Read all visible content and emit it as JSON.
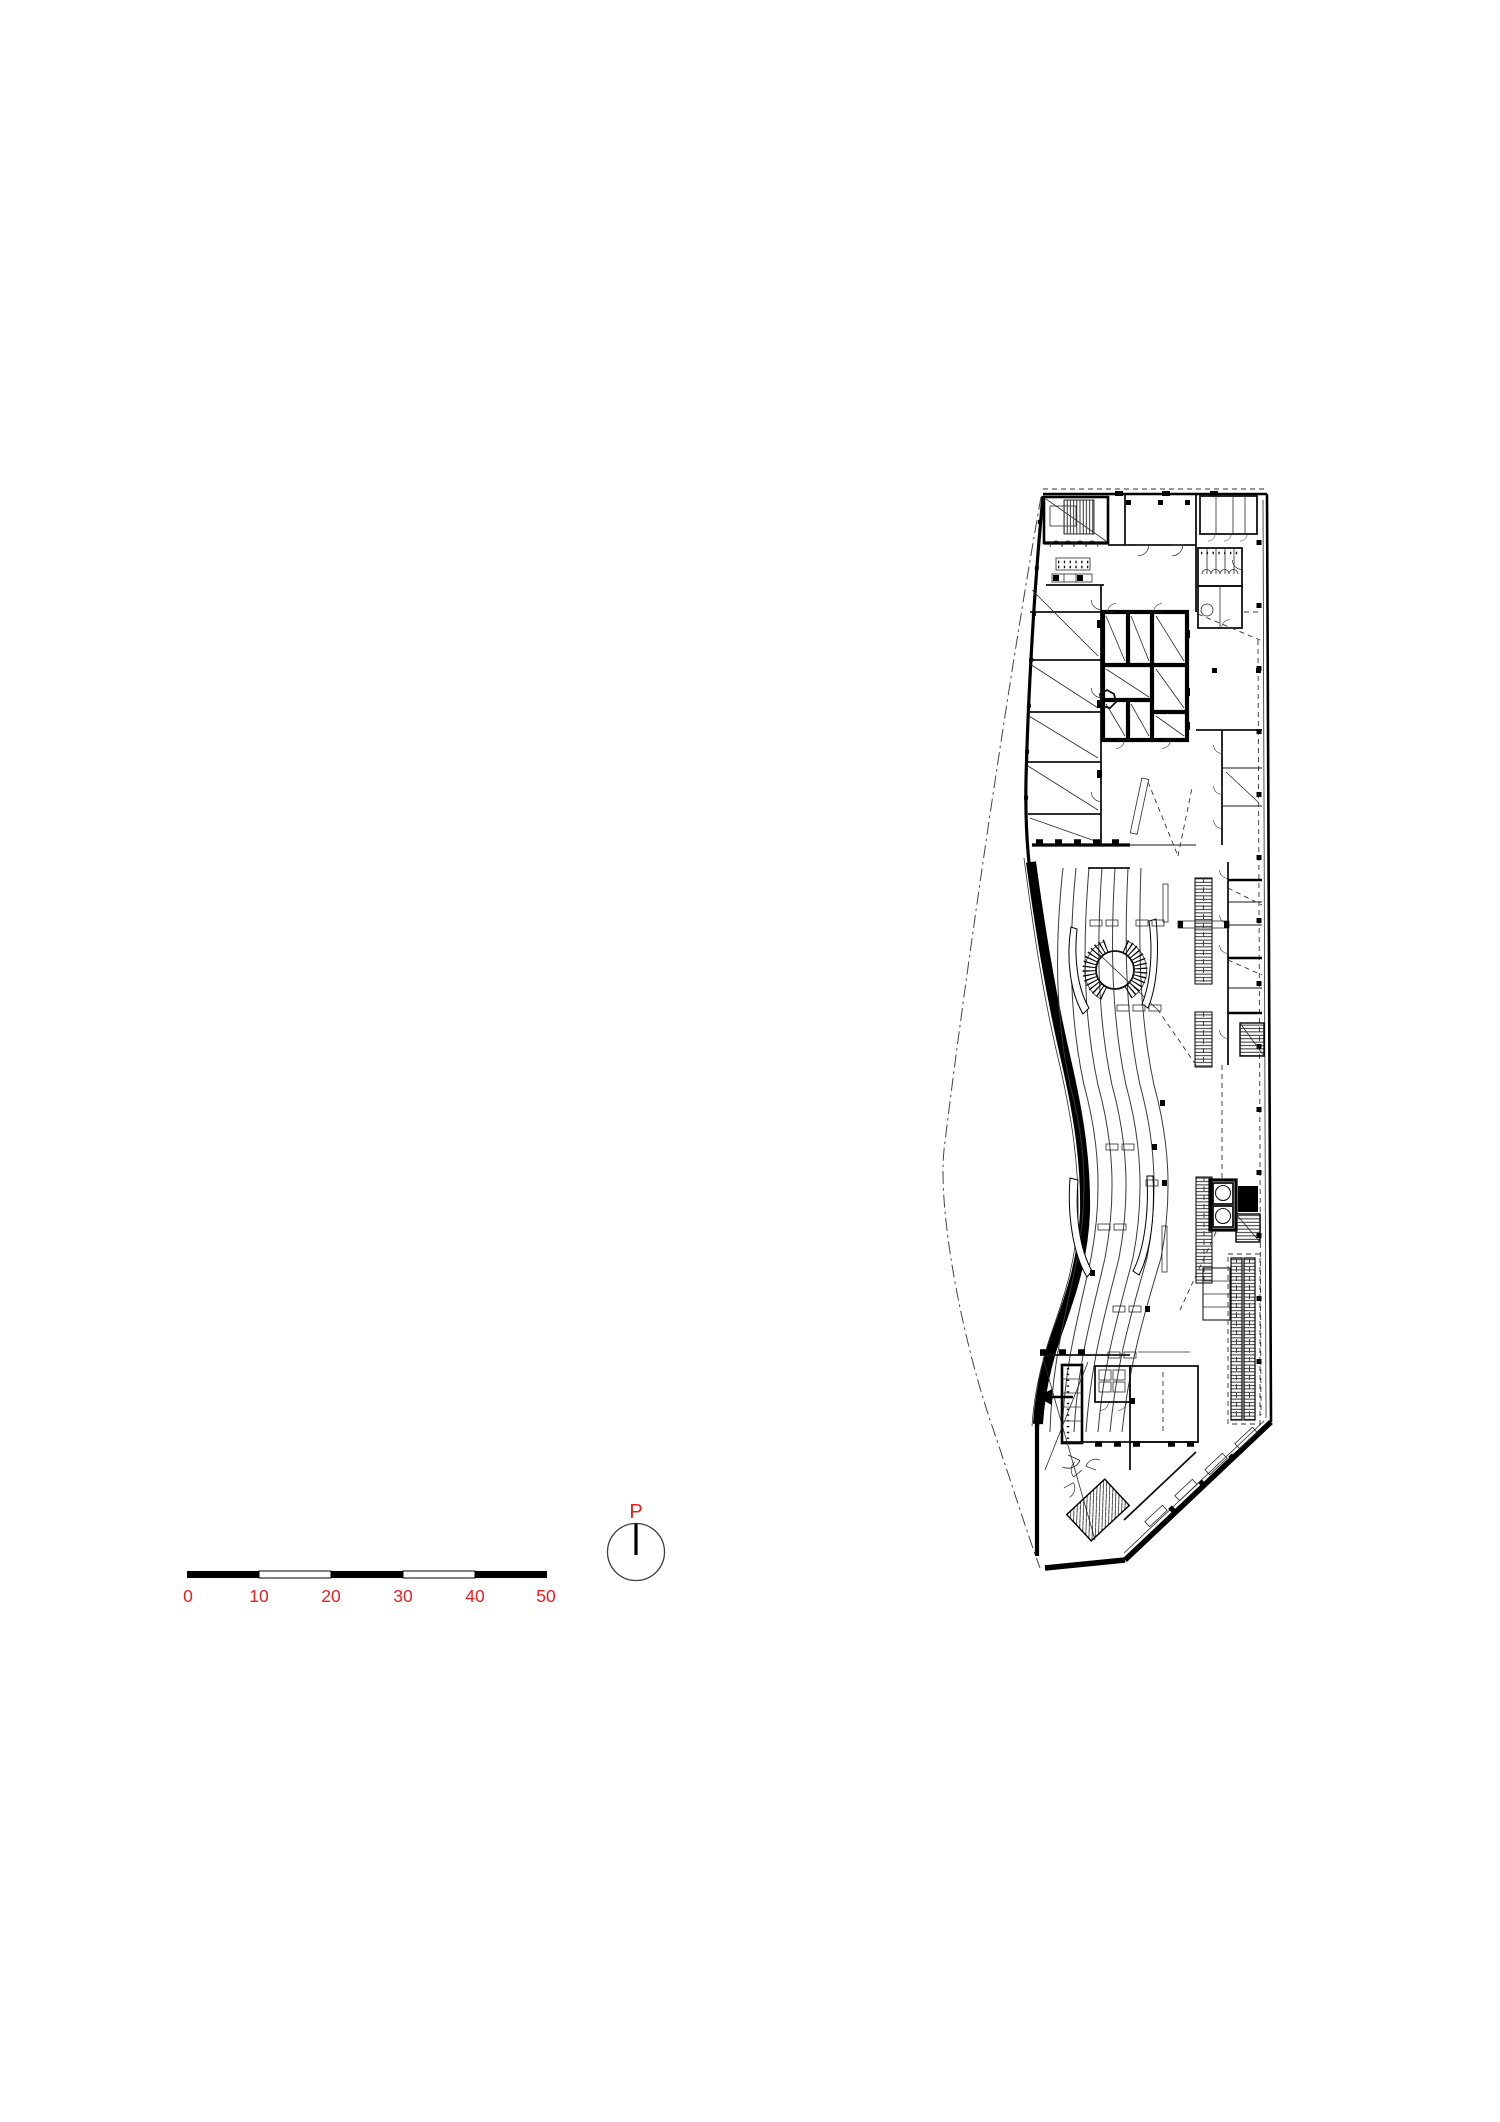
{
  "page": {
    "background_color": "#ffffff"
  },
  "plan": {
    "description": "Architectural floor plan of a wedge-shaped building with S-curved west facade, central service core, spiral stair, shelving rows, elevators, escalators and terraced ramp contour lines",
    "ink_color": "#000000"
  },
  "scale_bar": {
    "labels": [
      "0",
      "10",
      "20",
      "30",
      "40",
      "50"
    ],
    "label_color": "#e8201e",
    "bar_color": "#000000"
  },
  "compass": {
    "label": "P",
    "label_color": "#e8201e",
    "needle_color": "#000000"
  }
}
